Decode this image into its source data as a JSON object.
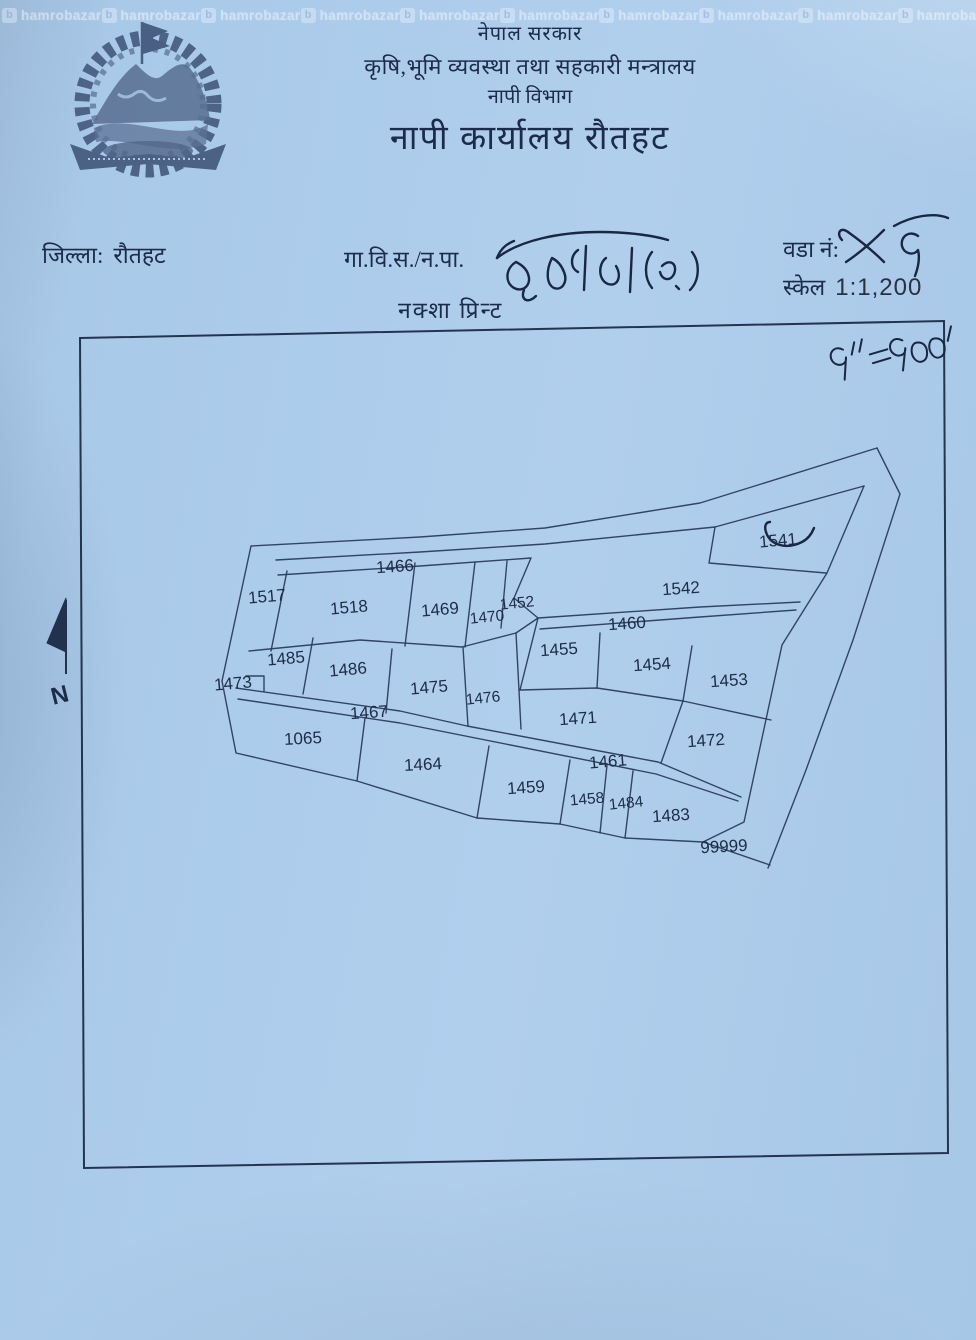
{
  "header": {
    "government": "नेपाल सरकार",
    "ministry": "कृषि,भूमि व्यवस्था तथा सहकारी मन्त्रालय",
    "department": "नापी विभाग",
    "office": "नापी कार्यालय रौतहट"
  },
  "fields": {
    "district_label": "जिल्ला:",
    "district_value": "रौतहट",
    "vdc_label": "गा.वि.स./न.पा.",
    "vdc_value_handwritten": "डुमरिया (क.)",
    "ward_label": "वडा नं:",
    "ward_value_handwritten": "५१",
    "scale_label": "स्केल",
    "scale_value": "1:1,200",
    "map_print_title": "नक्शा प्रिन्ट",
    "scale_note_handwritten": "१\" = १००'"
  },
  "map": {
    "north_label": "N",
    "parcel_labels": [
      "1466",
      "1517",
      "1518",
      "1469",
      "1470",
      "1452",
      "1542",
      "1541",
      "1460",
      "1455",
      "1454",
      "1453",
      "1485",
      "1486",
      "1473",
      "1475",
      "1476",
      "1467",
      "1471",
      "1472",
      "1065",
      "1464",
      "1461",
      "1459",
      "1458",
      "1484",
      "1483",
      "99999"
    ],
    "annotation_1541": "✓"
  },
  "watermark": {
    "text": "hamrobazar",
    "logo_letter": "b"
  },
  "colors": {
    "paper": "#a9c9e9",
    "printed_ink": "#1c2b4a",
    "map_line": "#2b3c5e",
    "handwriting_ink": "#1a2742",
    "watermark": "rgba(250,252,255,0.55)"
  }
}
